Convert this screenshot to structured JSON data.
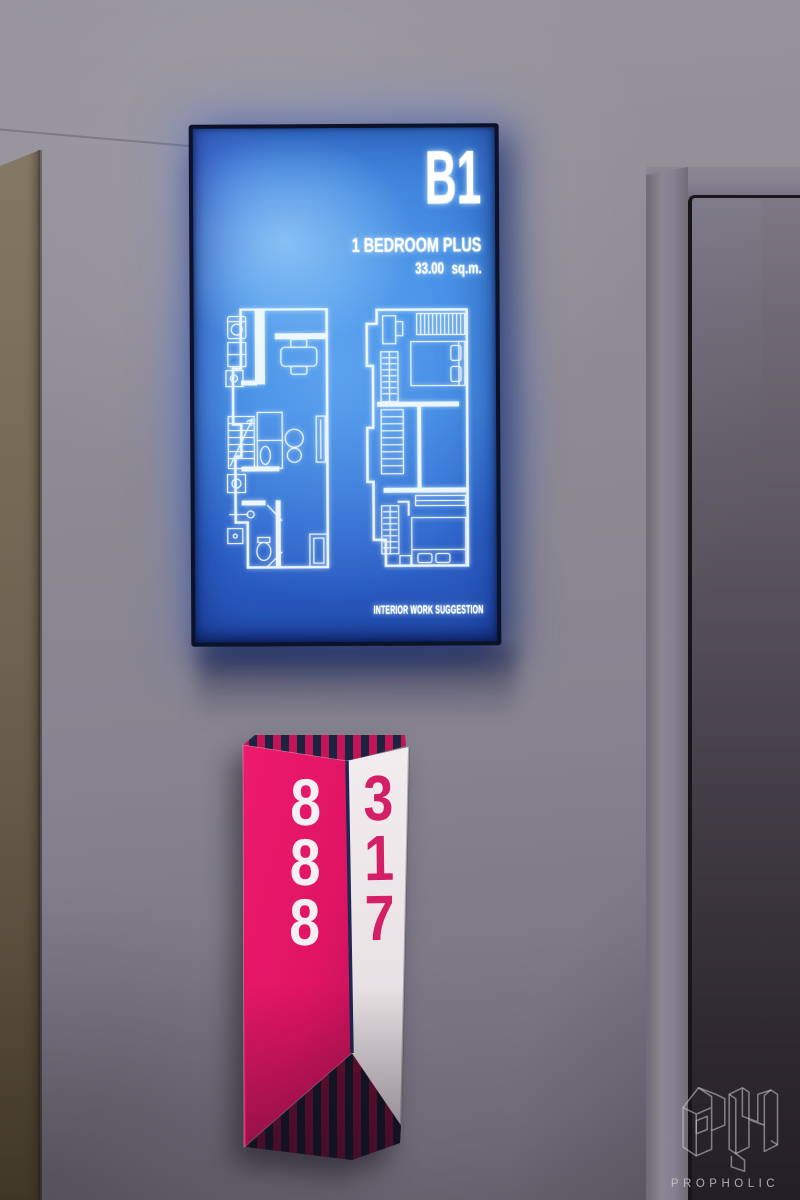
{
  "scene": {
    "lightbox": {
      "unit_code": "B1",
      "unit_type": "1 BEDROOM PLUS",
      "unit_area": "33.00 sq.m.",
      "footer_note": "INTERIOR WORK SUGGESTION",
      "screen_blue": "#3f82dc",
      "glow_blue": "#5584f0",
      "left_plan_icon": "floor-plan-lower-level",
      "right_plan_icon": "floor-plan-upper-level"
    },
    "room_sign": {
      "front_number": "888",
      "side_number": "317",
      "pink": "#e3156a",
      "navy": "#1c2442",
      "white_face": "#efe9ec"
    },
    "watermark": {
      "brand": "PROPHOLIC",
      "logo_icon": "propholic-ph-isometric-logo",
      "color": "#c9c6ce"
    }
  }
}
